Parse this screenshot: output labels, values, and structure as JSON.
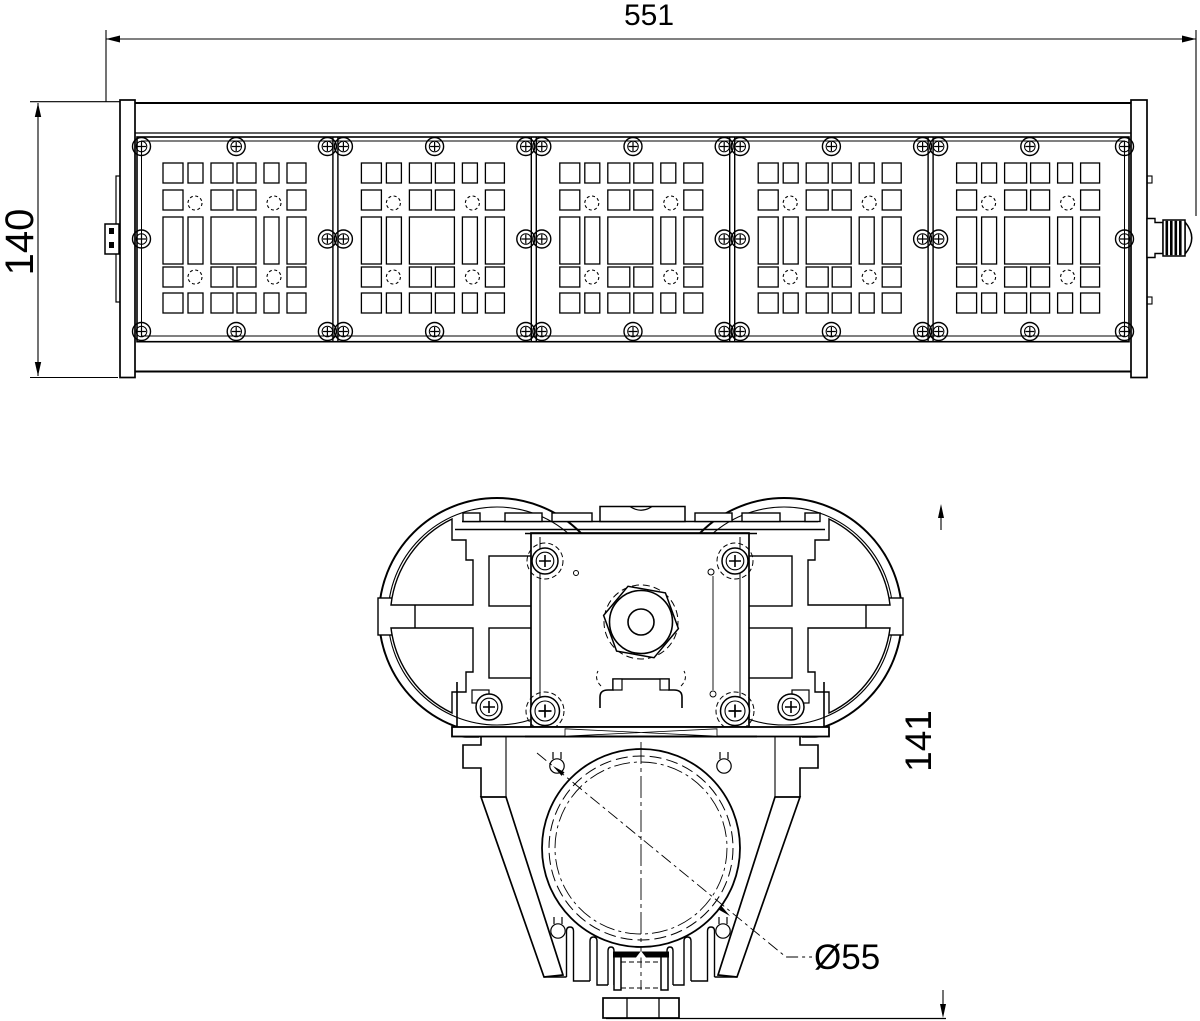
{
  "drawing": {
    "dimensions": {
      "front_length": "551",
      "front_height": "140",
      "section_height": "141",
      "pole_diameter": "Ø55"
    },
    "colors": {
      "line": "#000000",
      "background": "#ffffff"
    }
  }
}
